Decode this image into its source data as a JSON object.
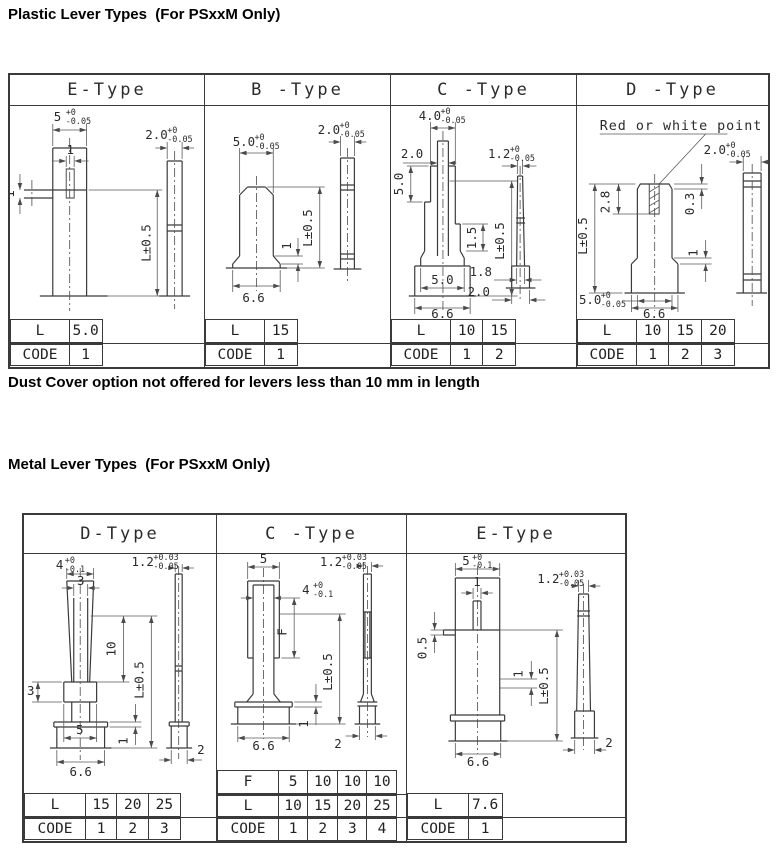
{
  "page": {
    "plastic_title": "Plastic Lever Types  (For PSxxM Only)",
    "note": "Dust Cover option not offered for levers less than 10 mm in length",
    "metal_title": "Metal Lever Types  (For PSxxM Only)"
  },
  "labels": {
    "L": "L",
    "CODE": "CODE",
    "F": "F"
  },
  "plastic": {
    "cols": [
      {
        "header": "E-Type",
        "L": [
          "5.0"
        ],
        "CODE": [
          "1"
        ]
      },
      {
        "header": "B -Type",
        "L": [
          "15"
        ],
        "CODE": [
          "1"
        ]
      },
      {
        "header": "C -Type",
        "L": [
          "10",
          "15"
        ],
        "CODE": [
          "1",
          "2"
        ]
      },
      {
        "header": "D -Type",
        "L": [
          "10",
          "15",
          "20"
        ],
        "CODE": [
          "1",
          "2",
          "3"
        ]
      }
    ]
  },
  "metal": {
    "cols": [
      {
        "header": "D-Type",
        "L": [
          "15",
          "20",
          "25"
        ],
        "CODE": [
          "1",
          "2",
          "3"
        ]
      },
      {
        "header": "C -Type",
        "F": [
          "5",
          "10",
          "10",
          "10"
        ],
        "L": [
          "10",
          "15",
          "20",
          "25"
        ],
        "CODE": [
          "1",
          "2",
          "3",
          "4"
        ]
      },
      {
        "header": "E-Type",
        "L": [
          "7.6"
        ],
        "CODE": [
          "1"
        ]
      }
    ]
  },
  "dims": {
    "pe": {
      "w": "5",
      "w_hi": "+0",
      "w_lo": "-0.05",
      "slot": "1",
      "tab": "1",
      "len": "L±0.5",
      "sw": "2.0",
      "sw_hi": "+0",
      "sw_lo": "-0.05"
    },
    "pb": {
      "w": "5.0",
      "w_hi": "+0",
      "w_lo": "-0.05",
      "step": "1",
      "len": "L±0.5",
      "base": "6.6",
      "sw": "2.0",
      "sw_hi": "+0",
      "sw_lo": "-0.05"
    },
    "pc": {
      "w": "4.0",
      "w_hi": "+0",
      "w_lo": "-0.05",
      "blade": "2.0",
      "neck": "5.0",
      "step": "1.5",
      "len": "L±0.5",
      "mid": "5.0",
      "base": "6.6",
      "sw": "1.2",
      "sw_hi": "+0",
      "sw_lo": "-0.05",
      "root": "1.8",
      "foot": "2.0"
    },
    "pd": {
      "note": "Red or white point",
      "len": "L±0.5",
      "slot": "2.8",
      "dome": "0.3",
      "skirt": "1",
      "w": "5.0",
      "w_hi": "+0",
      "w_lo": "-0.05",
      "base": "6.6",
      "sw": "2.0",
      "sw_hi": "+0",
      "sw_lo": "-0.05"
    },
    "md": {
      "w": "4",
      "w_hi": "+0",
      "w_lo": "-0.1",
      "tip": "3",
      "ten": "10",
      "len": "L±0.5",
      "collar": "3",
      "five": "5",
      "base": "6.6",
      "one": "1",
      "sw": "1.2",
      "sw_hi": "+0.03",
      "sw_lo": "-0.05",
      "two": "2"
    },
    "mc": {
      "w": "5",
      "w4": "4",
      "w4_hi": "+0",
      "w4_lo": "-0.1",
      "f": "F",
      "len": "L±0.5",
      "base": "6.6",
      "one": "1",
      "sw": "1.2",
      "sw_hi": "+0.03",
      "sw_lo": "-0.05",
      "two": "2"
    },
    "me": {
      "w": "5",
      "w_hi": "+0",
      "w_lo": "-0.1",
      "slot": "1",
      "step": "0.5",
      "one": "1",
      "len": "L±0.5",
      "base": "6.6",
      "sw": "1.2",
      "sw_hi": "+0.03",
      "sw_lo": "-0.05",
      "two": "2"
    }
  }
}
